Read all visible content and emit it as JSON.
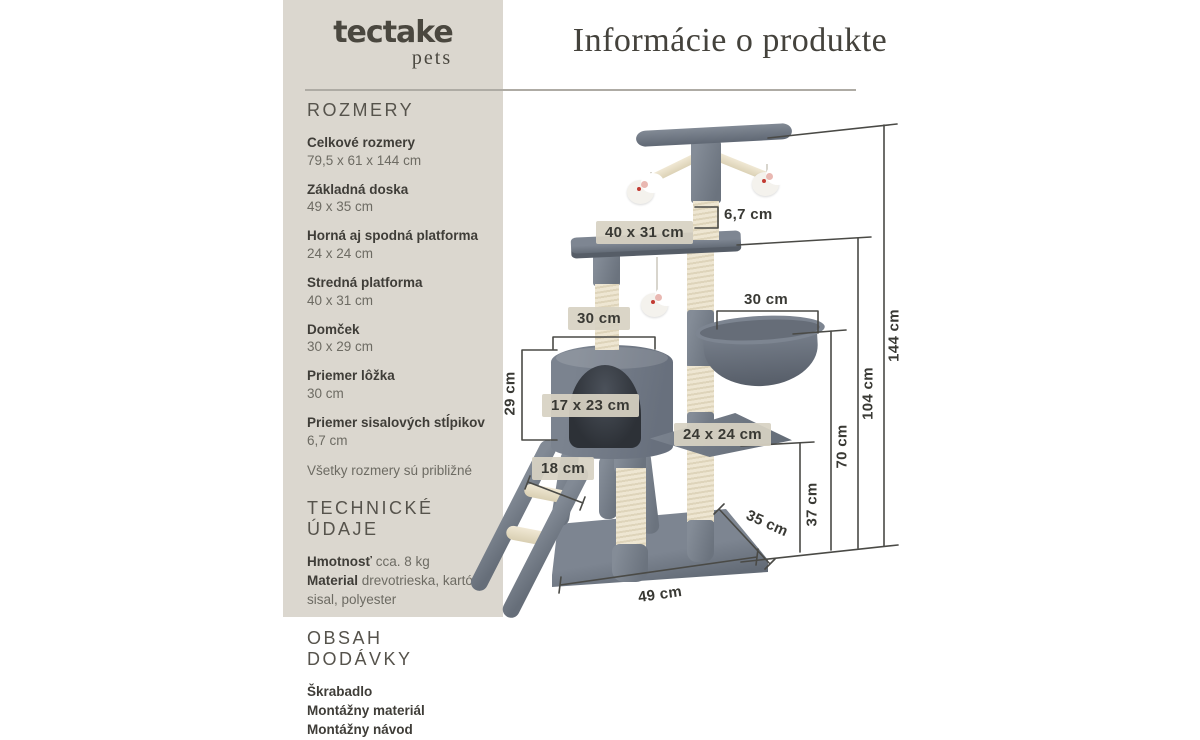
{
  "brand": {
    "name": "tectake",
    "sub": "pets"
  },
  "header": {
    "title": "Informácie o produkte"
  },
  "sidebar": {
    "sections": [
      {
        "heading": "ROZMERY",
        "items": [
          {
            "label": "Celkové rozmery",
            "value": "79,5 x 61 x 144 cm"
          },
          {
            "label": "Základná doska",
            "value": "49 x 35 cm"
          },
          {
            "label": "Horná aj spodná platforma",
            "value": "24 x 24 cm"
          },
          {
            "label": "Stredná platforma",
            "value": "40 x 31 cm"
          },
          {
            "label": "Domček",
            "value": "30 x 29 cm"
          },
          {
            "label": "Priemer lôžka",
            "value": "30 cm"
          },
          {
            "label": "Priemer sisalových stĺpikov",
            "value": "6,7 cm"
          }
        ],
        "note": "Všetky rozmery sú približné"
      },
      {
        "heading": "TECHNICKÉ ÚDAJE",
        "rows": [
          {
            "label": "Hmotnosť",
            "value": " cca. 8 kg"
          },
          {
            "label": "Material",
            "value": " drevotrieska, kartón, sisal, polyester"
          }
        ]
      },
      {
        "heading": "OBSAH DODÁVKY",
        "lines": [
          "Škrabadlo",
          "Montážny materiál",
          "Montážny návod"
        ]
      }
    ]
  },
  "diagram": {
    "labels": {
      "post_diameter": "6,7 cm",
      "mid_platform": "40 x 31 cm",
      "house_width": "30 cm",
      "basket_width": "30 cm",
      "house_height": "29 cm",
      "house_door": "17 x 23 cm",
      "small_platform": "24 x 24 cm",
      "ladder_step": "18 cm",
      "base_depth": "35 cm",
      "base_width": "49 cm",
      "height_37": "37 cm",
      "height_70": "70 cm",
      "height_104": "104 cm",
      "height_144": "144 cm"
    },
    "colors": {
      "sidebar_bg": "#dbd7cf",
      "plush_gray": "#78808b",
      "sisal_cream": "#ece4cf",
      "label_box": "#d7d2c3",
      "dim_line": "#4a4a46",
      "text_dark": "#3f3d38"
    }
  }
}
